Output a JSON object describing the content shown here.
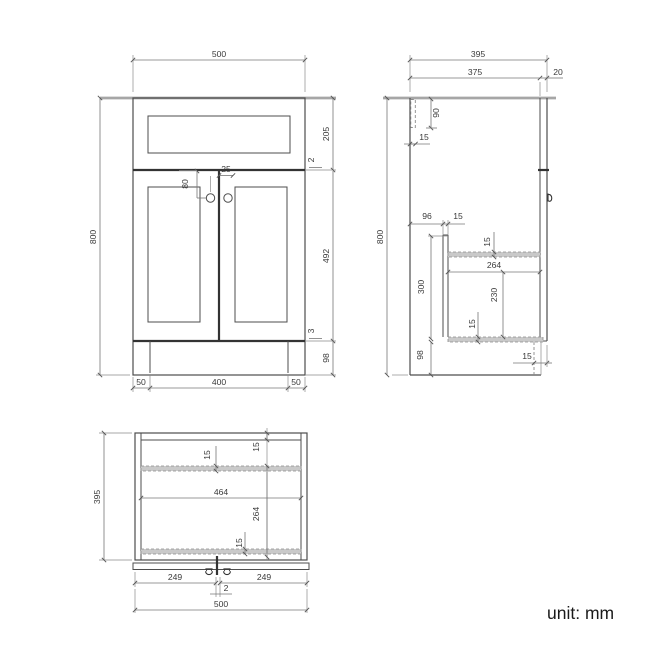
{
  "footer": {
    "unit_label": "unit: mm"
  },
  "front_view": {
    "overall_width": "500",
    "overall_height": "800",
    "drawer_front_height": "205",
    "drawer_door_gap": "2",
    "door_height": "492",
    "door_plinth_gap": "3",
    "plinth_height": "98",
    "knob_from_top": "80",
    "knob_from_center": "25",
    "plinth_inset_left": "50",
    "plinth_width": "400",
    "plinth_inset_right": "50"
  },
  "side_view": {
    "overall_depth": "395",
    "carcass_depth": "375",
    "door_thickness": "20",
    "overall_height": "800",
    "hanger_height": "90",
    "hanger_width": "15",
    "panel_from_back": "96",
    "panel_thickness": "15",
    "shelf_thickness": "15",
    "interior_depth": "264",
    "panel_height": "300",
    "interior_height": "230",
    "bottom_thickness": "15",
    "plinth_height": "98",
    "plinth_recess": "15"
  },
  "bottom_view": {
    "overall_depth": "395",
    "rail_thickness": "15",
    "back_thickness": "15",
    "interior_width": "464",
    "interior_depth": "264",
    "bottom_rail_thickness": "15",
    "door_left_width": "249",
    "door_gap": "2",
    "door_right_width": "249",
    "overall_width": "500"
  },
  "icons": {
    "front_knobs": "door-knob-circle",
    "side_knob": "door-knob-side",
    "bottom_knobs": "door-knob-underside"
  },
  "colors": {
    "object_line": "#4d4d4d",
    "heavy_line": "#333333",
    "worktop_gray": "#a6a6a6",
    "panel_fill_gray": "#c9c9c9",
    "dimension_line": "#777777",
    "text": "#3a3a3a",
    "unit_text": "#1a1a1a",
    "background": "#ffffff"
  }
}
